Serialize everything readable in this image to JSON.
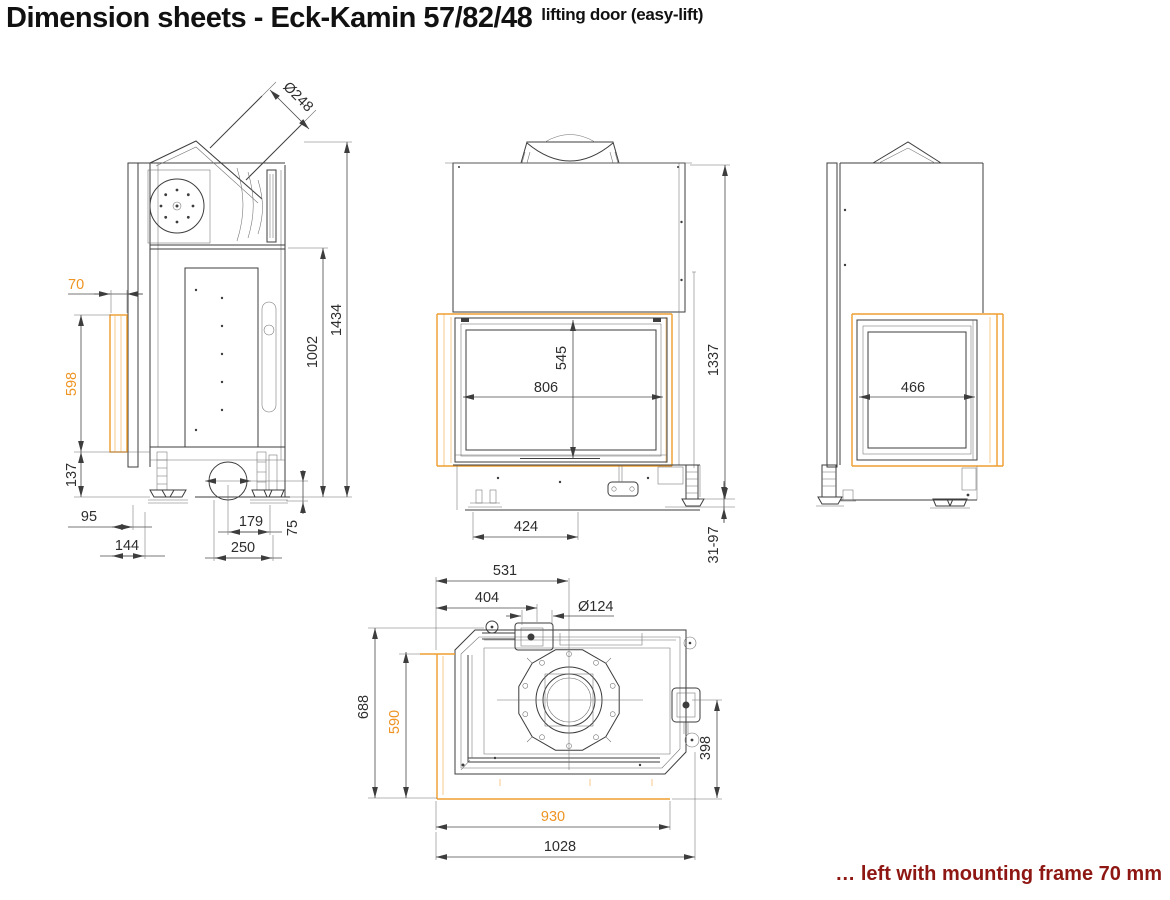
{
  "header": {
    "title": "Dimension sheets - Eck-Kamin 57/82/48",
    "subtitle": "lifting door (easy-lift)"
  },
  "footer": {
    "caption": "… left with mounting frame 70 mm"
  },
  "colors": {
    "drawing_line": "#3d3d3d",
    "mounting_frame_accent": "#ef9d2e",
    "caption_red": "#8e1713"
  },
  "views": {
    "side_left": {
      "dims": {
        "flue_diameter": "Ø248",
        "frame_depth": "70",
        "frame_height": "598",
        "plinth_height": "137",
        "total_height": "1434",
        "upper_body_height": "1002",
        "front_to_foot": "95",
        "frame_to_foot_depth": "144",
        "air_inlet_offset": "179",
        "air_inlet_height": "75",
        "base_depth": "250"
      }
    },
    "front": {
      "dims": {
        "glass_height": "545",
        "glass_width": "806",
        "total_height": "1337",
        "foot_offset": "424",
        "foot_adjustment": "31-97"
      }
    },
    "side_right": {
      "dims": {
        "glass_width": "466"
      }
    },
    "top": {
      "dims": {
        "flue_from_left": "531",
        "connector_from_left": "404",
        "connector_diameter": "Ø124",
        "total_depth": "688",
        "frame_side": "590",
        "flue_from_front": "398",
        "frame_width": "930",
        "total_width": "1028"
      }
    }
  }
}
